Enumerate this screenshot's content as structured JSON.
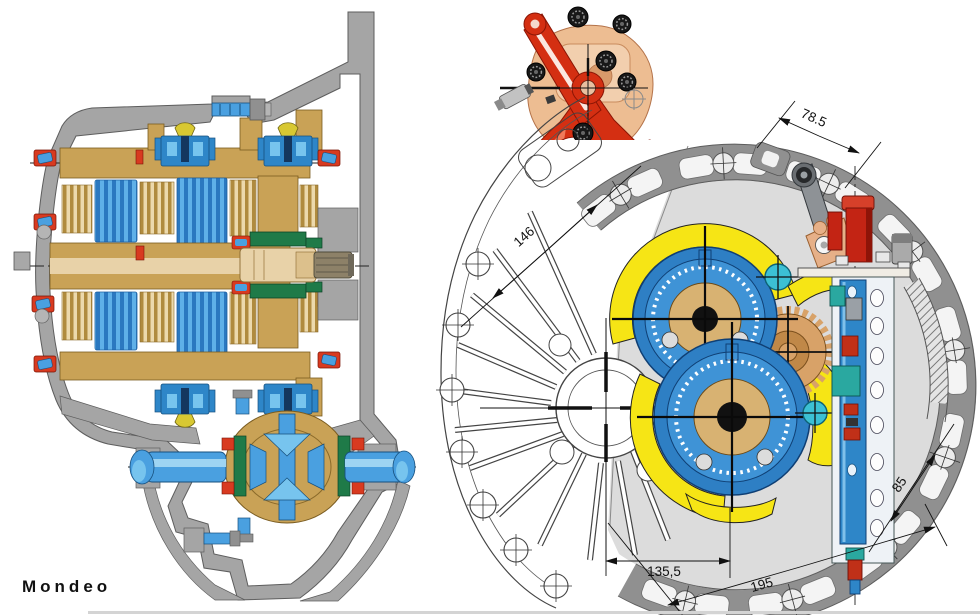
{
  "caption": "Mondeo",
  "views": {
    "section_view": "gearbox-longitudinal-cross-section",
    "linkage_view": "gear-shift-linkage-detail",
    "end_view": "clutch-housing-end-view-with-dimensions"
  },
  "dimensions": {
    "top_width": "78.5",
    "upper_left_diagonal": "146",
    "lower_right_diagonal": "85",
    "bottom_center_distance": "135,5",
    "bottom_overall": "195"
  },
  "colors": {
    "housing_gray": "#a5a5a5",
    "interior_gray": "#dcdcdc",
    "line_art": "#444444",
    "gear_tan": "#c9a256",
    "shaft_tan": "#e8d2a8",
    "gear_tan_dark": "#b08b3e",
    "part_blue": "#2e86c8",
    "part_blue_light": "#77c4ee",
    "bearing_red": "#d83a20",
    "seal_green": "#1f7a48",
    "oil_baffle_yellow": "#f6e515",
    "mechanism_red": "#d42f12",
    "mechanism_salmon": "#edbd92",
    "coolant_cyan": "#3cc0d4",
    "teal": "#2aa8a0",
    "knob_black": "#1c1c1c"
  }
}
